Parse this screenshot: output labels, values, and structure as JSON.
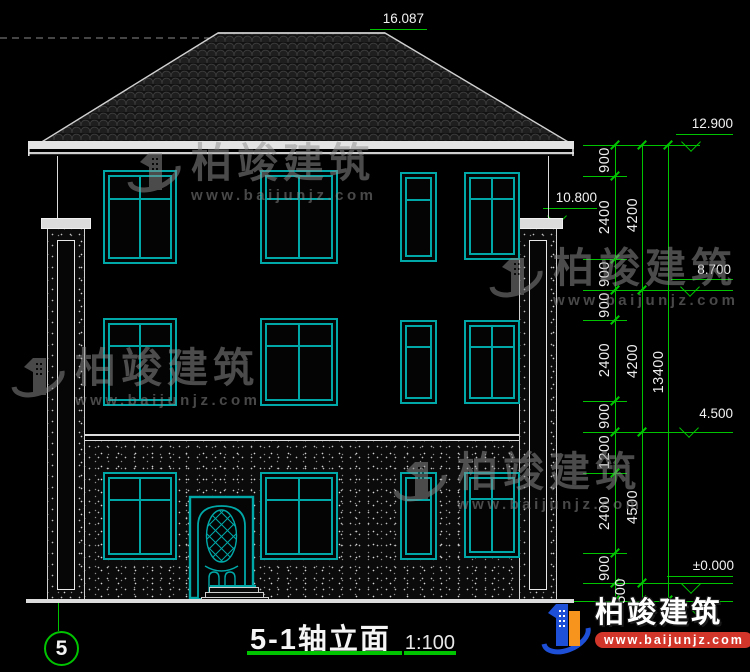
{
  "title_block": {
    "title": "5-1轴立面",
    "scale": "1:100"
  },
  "axis_bubble": {
    "label": "5"
  },
  "elevations": {
    "ridge": "16.087",
    "eave": "12.900",
    "column_top": "10.800",
    "level3": "8.700",
    "level2": "4.500",
    "door_top": "2.400",
    "zero": "±0.000"
  },
  "dims": {
    "chain1": [
      "900",
      "2400",
      "900",
      "900",
      "2400",
      "900",
      "1200",
      "2400",
      "900",
      "500"
    ],
    "chain2": [
      "4200",
      "4200",
      "4500"
    ],
    "total": "13400"
  },
  "watermark": {
    "brand": "柏竣建筑",
    "url": "www.baijunjz.com"
  },
  "footer_logo": {
    "brand": "柏竣建筑",
    "url": "www.baijunjz.com"
  },
  "colors": {
    "cad_green": "#00c400",
    "window_teal": "#00a8a8",
    "wall_white": "#dcdcdc",
    "banner_red": "#d2362b",
    "logo_blue": "#1d4fd7",
    "logo_orange": "#f7941d"
  }
}
